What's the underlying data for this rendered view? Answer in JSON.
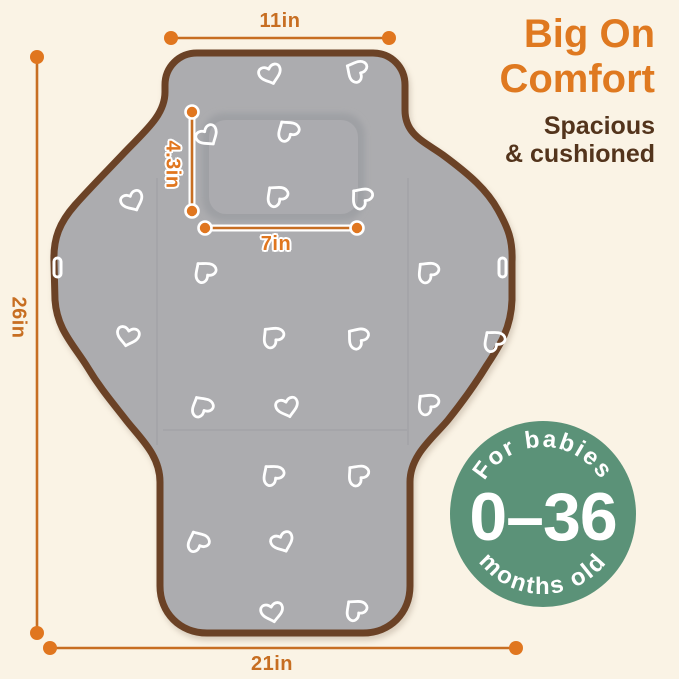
{
  "headline": {
    "line1": "Big On",
    "line2": "Comfort",
    "subline1": "Spacious",
    "subline2": "& cushioned"
  },
  "dimensions": {
    "width_top": "11in",
    "height_left": "26in",
    "width_bottom": "21in",
    "pillow_height": "4.3in",
    "pillow_width": "7in"
  },
  "badge": {
    "arc_top": "For babies",
    "value": "0–36",
    "arc_bottom": "months old"
  },
  "colors": {
    "background_cream": "#FAF3E5",
    "accent_orange": "#DF7920",
    "dim_orange": "#C76E22",
    "dot_orange": "#E0761F",
    "text_brown": "#53341C",
    "badge_green": "#5B9278",
    "pad_gray": "#ACACAF",
    "binding_brown": "#6B4226",
    "heart_white": "#FFFFFF"
  },
  "illustration": {
    "subject": "portable-baby-changing-pad-unfolded",
    "pattern": "white-outline-hearts",
    "hearts": [
      {
        "x": 270,
        "y": 73,
        "r": -18
      },
      {
        "x": 357,
        "y": 71,
        "r": 118
      },
      {
        "x": 207,
        "y": 135,
        "r": -35
      },
      {
        "x": 288,
        "y": 131,
        "r": 145
      },
      {
        "x": 277,
        "y": 196,
        "r": 138
      },
      {
        "x": 362,
        "y": 198,
        "r": 130
      },
      {
        "x": 132,
        "y": 200,
        "r": -25
      },
      {
        "x": 205,
        "y": 272,
        "r": 140
      },
      {
        "x": 428,
        "y": 272,
        "r": 135
      },
      {
        "x": 128,
        "y": 335,
        "r": 12
      },
      {
        "x": 273,
        "y": 337,
        "r": 135
      },
      {
        "x": 358,
        "y": 338,
        "r": 128
      },
      {
        "x": 494,
        "y": 341,
        "r": 140
      },
      {
        "x": 202,
        "y": 407,
        "r": 150
      },
      {
        "x": 287,
        "y": 406,
        "r": -15
      },
      {
        "x": 428,
        "y": 404,
        "r": 135
      },
      {
        "x": 273,
        "y": 475,
        "r": 140
      },
      {
        "x": 358,
        "y": 475,
        "r": 132
      },
      {
        "x": 198,
        "y": 542,
        "r": 155
      },
      {
        "x": 282,
        "y": 541,
        "r": -22
      },
      {
        "x": 272,
        "y": 611,
        "r": -12
      },
      {
        "x": 356,
        "y": 610,
        "r": 138
      }
    ]
  }
}
